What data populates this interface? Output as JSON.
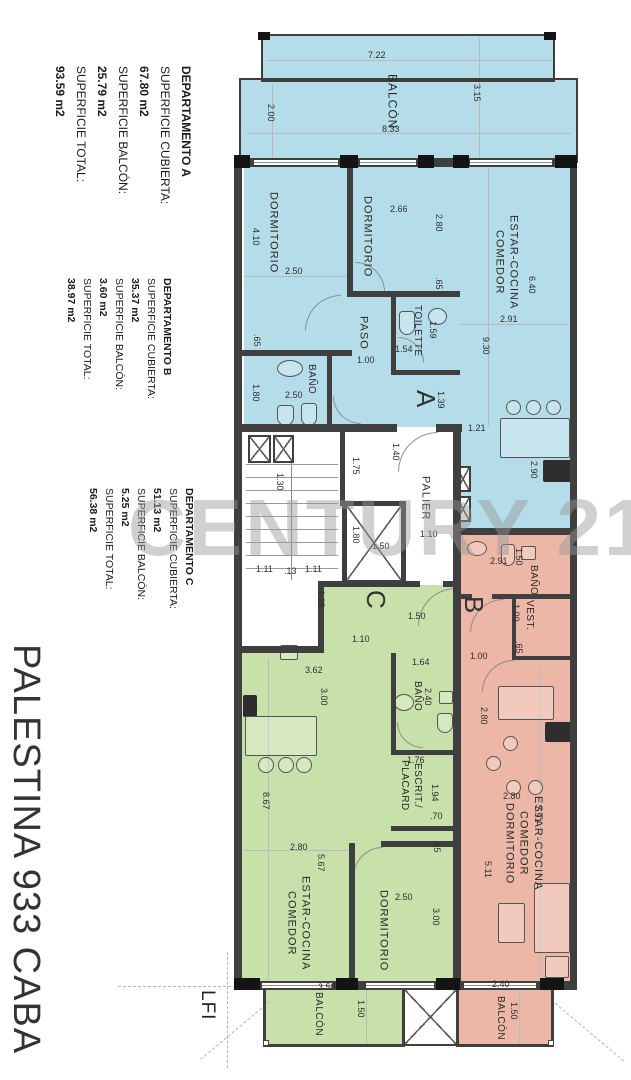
{
  "project": {
    "name": "PALESTINA 933 CABA",
    "level": "LFI",
    "watermark": "CENTURY 21"
  },
  "departments": [
    {
      "lines": [
        "DEPARTAMENTO A",
        "SUPERFICIE CUBIERTA:",
        "67.80 m2",
        "SUPERFICIE BALCÓN:",
        "25.79 m2",
        "SUPERFICIE TOTAL:",
        "93.59 m2"
      ]
    },
    {
      "lines": [
        "DEPARTAMENTO B",
        "SUPERFICIE CUBIERTA:",
        "35.37 m2",
        "SUPERFICIE BALCÓN:",
        "3.60 m2",
        "SUPERFICIE TOTAL:",
        "38.97 m2"
      ]
    },
    {
      "lines": [
        "DEPARTAMENTO C",
        "SUPERFICIE CUBIERTA:",
        "51.13 m2",
        "SUPERFICIE BALCÓN:",
        "5.25 m2",
        "SUPERFICIE TOTAL:",
        "56.38 m2"
      ]
    }
  ],
  "units": [
    {
      "letter": "A"
    },
    {
      "letter": "B"
    },
    {
      "letter": "C"
    }
  ],
  "rooms": {
    "balcony_top": "BALCÓN",
    "a_dorm1": "DORMITORIO",
    "a_dorm2": "DORMITORIO",
    "a_paso": "PASO",
    "a_toilette": "TOILETTE",
    "a_bath": "BAÑO",
    "a_living": "ESTAR-COCINA\nCOMEDOR",
    "palier": "PALIER",
    "b_bath": "BAÑO",
    "b_vest": "VEST.",
    "b_living": "ESTAR-COCINA\nCOMEDOR\nDORMITORIO",
    "b_balcony": "BALCÓN",
    "c_bath": "BAÑO",
    "c_desk": "ESCRIT./\nPLACARD",
    "c_living": "ESTAR-COCINA\nCOMEDOR",
    "c_dorm": "DORMITORIO",
    "c_balcony": "BALCÓN"
  },
  "dims": {
    "tb_722": "7.22",
    "tb_315": "3.15",
    "tb_200": "2.00",
    "tb_833": "8.33",
    "a_410": "4.10",
    "a_250a": "2.50",
    "a_65a": ".65",
    "a_180a": "1.80",
    "a_266": "2.66",
    "a_280": "2.80",
    "a_65b": ".65",
    "a_100": "1.00",
    "a_159": "1.59",
    "a_154": "1.54",
    "a_250b": "2.50",
    "a_139": "1.39",
    "a_640": "6.40",
    "a_291": "2.91",
    "a_930": "9.30",
    "a_121": "1.21",
    "a_290": "2.90",
    "s_130": "1.30",
    "s_175": "1.75",
    "s_140": "1.40",
    "s_111a": "1.11",
    "s_013": ".13",
    "s_111b": "1.11",
    "s_125": "1.25",
    "p_110": "1.10",
    "p_180": "1.80",
    "p_150a": "1.50",
    "p_150b": "1.50",
    "c_110": "1.10",
    "c_362": "3.62",
    "c_300a": "3.00",
    "c_164": "1.64",
    "c_240": "2.40",
    "c_176": "1.76",
    "c_194": "1.94",
    "c_070": ".70",
    "c_065": ".65",
    "c_867": "8.67",
    "c_280": "2.80",
    "c_567": "5.67",
    "c_250": "2.50",
    "c_300b": "3.00",
    "c_350": "3.50",
    "c_150": "1.50",
    "b_291": "2.91",
    "b_150a": "1.50",
    "b_100v": "1.00",
    "b_065": ".65",
    "b_100h": "1.00",
    "b_280v": "2.80",
    "b_280h": "2.80",
    "b_791": "7.91",
    "b_511": "5.11",
    "b_240": "2.40",
    "b_150b": "1.50"
  },
  "colors": {
    "unit_a": "#b5dde9",
    "unit_b": "#ecb7a7",
    "unit_c": "#c8e0aa",
    "wall": "#3f3f3f"
  }
}
